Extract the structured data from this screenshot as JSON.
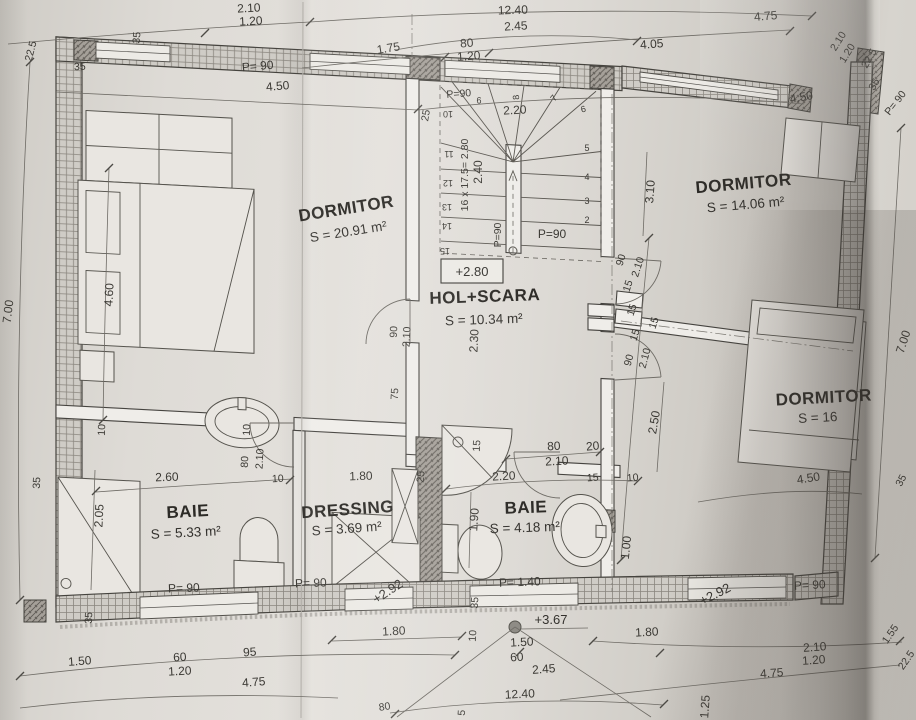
{
  "plan": {
    "rooms": [
      {
        "id": "dormitor-1",
        "name": "DORMITOR",
        "area": "S = 20.91 m²"
      },
      {
        "id": "dormitor-2",
        "name": "DORMITOR",
        "area": "S = 14.06 m²"
      },
      {
        "id": "dormitor-3",
        "name": "DORMITOR",
        "area": "S = 16"
      },
      {
        "id": "hol-scara",
        "name": "HOL+SCARA",
        "area": "S = 10.34 m²"
      },
      {
        "id": "baie-1",
        "name": "BAIE",
        "area": "S = 5.33 m²"
      },
      {
        "id": "dressing",
        "name": "DRESSING",
        "area": "S = 3.69 m²"
      },
      {
        "id": "baie-2",
        "name": "BAIE",
        "area": "S = 4.18 m²"
      }
    ],
    "level_marks": [
      "+2.80",
      "+2.92",
      "+3.67",
      "+2.92"
    ],
    "stair_note": "16 x 17.5= 2.80",
    "dimension_labels": [
      {
        "t": "2.10",
        "x": 249,
        "y": 12,
        "r": -3
      },
      {
        "t": "1.20",
        "x": 251,
        "y": 25,
        "r": -3
      },
      {
        "t": "12.40",
        "x": 513,
        "y": 14,
        "r": -2
      },
      {
        "t": "2.45",
        "x": 516,
        "y": 30,
        "r": -3
      },
      {
        "t": "1.75",
        "x": 389,
        "y": 52,
        "r": -9
      },
      {
        "t": "80",
        "x": 467,
        "y": 47,
        "r": -4
      },
      {
        "t": "1.20",
        "x": 469,
        "y": 60,
        "r": -4
      },
      {
        "t": "4.05",
        "x": 652,
        "y": 48,
        "r": -4
      },
      {
        "t": "4.75",
        "x": 766,
        "y": 20,
        "r": -5
      },
      {
        "t": "22.5",
        "x": 34,
        "y": 52,
        "r": -75,
        "c": "sm"
      },
      {
        "t": "35",
        "x": 80,
        "y": 70,
        "r": -3,
        "c": "sm"
      },
      {
        "t": "35",
        "x": 140,
        "y": 38,
        "r": -85,
        "c": "sm"
      },
      {
        "t": "P= 90",
        "x": 258,
        "y": 70,
        "r": -5
      },
      {
        "t": "4.50",
        "x": 278,
        "y": 90,
        "r": -5
      },
      {
        "t": "P=90",
        "x": 459,
        "y": 97,
        "r": -4,
        "c": "sm"
      },
      {
        "t": "2.20",
        "x": 515,
        "y": 114,
        "r": -3
      },
      {
        "t": "4.50",
        "x": 802,
        "y": 101,
        "r": -10
      },
      {
        "t": "2.10",
        "x": 841,
        "y": 43,
        "r": -58,
        "c": "sm"
      },
      {
        "t": "1.20",
        "x": 850,
        "y": 55,
        "r": -58,
        "c": "sm"
      },
      {
        "t": "22.5",
        "x": 872,
        "y": 60,
        "r": -60,
        "c": "sm"
      },
      {
        "t": "35",
        "x": 877,
        "y": 86,
        "r": -60,
        "c": "sm"
      },
      {
        "t": "P= 90",
        "x": 898,
        "y": 105,
        "r": -52,
        "c": "sm"
      },
      {
        "t": "9",
        "x": 479,
        "y": 97,
        "r": 180,
        "c": "xs"
      },
      {
        "t": "10",
        "x": 448,
        "y": 111,
        "r": 180,
        "c": "xs"
      },
      {
        "t": "8",
        "x": 519,
        "y": 97,
        "r": -95,
        "c": "xs"
      },
      {
        "t": "7",
        "x": 556,
        "y": 100,
        "r": -50,
        "c": "xs"
      },
      {
        "t": "6",
        "x": 584,
        "y": 112,
        "r": -15,
        "c": "xs"
      },
      {
        "t": "5",
        "x": 587,
        "y": 151,
        "c": "xs"
      },
      {
        "t": "4",
        "x": 587,
        "y": 180,
        "c": "xs"
      },
      {
        "t": "3",
        "x": 587,
        "y": 204,
        "c": "xs"
      },
      {
        "t": "2",
        "x": 587,
        "y": 223,
        "c": "xs"
      },
      {
        "t": "11",
        "x": 449,
        "y": 151,
        "r": 180,
        "c": "xs"
      },
      {
        "t": "12",
        "x": 448,
        "y": 180,
        "r": 180,
        "c": "xs"
      },
      {
        "t": "13",
        "x": 447,
        "y": 204,
        "r": 180,
        "c": "xs"
      },
      {
        "t": "14",
        "x": 447,
        "y": 223,
        "r": 180,
        "c": "xs"
      },
      {
        "t": "15",
        "x": 445,
        "y": 248,
        "r": 180,
        "c": "xs"
      },
      {
        "t": "16 x 17.5= 2.80",
        "x": 468,
        "y": 175,
        "r": -90,
        "c": "sm"
      },
      {
        "t": "2.40",
        "x": 482,
        "y": 172,
        "r": -90
      },
      {
        "t": "P=90",
        "x": 501,
        "y": 235,
        "r": -90,
        "c": "sm"
      },
      {
        "t": "P=90",
        "x": 552,
        "y": 238
      },
      {
        "t": "25",
        "x": 429,
        "y": 116,
        "r": -80,
        "c": "sm"
      },
      {
        "t": "25",
        "x": 424,
        "y": 477,
        "r": -85,
        "c": "sm"
      },
      {
        "t": "7.00",
        "x": 12,
        "y": 312,
        "r": -83
      },
      {
        "t": "4.60",
        "x": 113,
        "y": 295,
        "r": -87
      },
      {
        "t": "10",
        "x": 105,
        "y": 430,
        "r": -87,
        "c": "sm"
      },
      {
        "t": "35",
        "x": 40,
        "y": 483,
        "r": -87,
        "c": "sm"
      },
      {
        "t": "2.05",
        "x": 103,
        "y": 516,
        "r": -87
      },
      {
        "t": "2.60",
        "x": 167,
        "y": 481,
        "r": -2
      },
      {
        "t": "10",
        "x": 250,
        "y": 430,
        "r": -87,
        "c": "sm"
      },
      {
        "t": "80",
        "x": 248,
        "y": 462,
        "r": -87,
        "c": "sm"
      },
      {
        "t": "2.10",
        "x": 263,
        "y": 459,
        "r": -87,
        "c": "sm"
      },
      {
        "t": "10",
        "x": 278,
        "y": 482,
        "r": -3,
        "c": "sm"
      },
      {
        "t": "1.80",
        "x": 361,
        "y": 480,
        "r": -2
      },
      {
        "t": "90",
        "x": 397,
        "y": 332,
        "r": -87,
        "c": "sm"
      },
      {
        "t": "2.10",
        "x": 410,
        "y": 337,
        "r": -87,
        "c": "sm"
      },
      {
        "t": "75",
        "x": 398,
        "y": 394,
        "r": -87,
        "c": "sm"
      },
      {
        "t": "2.30",
        "x": 478,
        "y": 341,
        "r": -87
      },
      {
        "t": "35",
        "x": 92,
        "y": 618,
        "r": -87,
        "c": "sm"
      },
      {
        "t": "90",
        "x": 624,
        "y": 261,
        "r": -72,
        "c": "sm"
      },
      {
        "t": "2.10",
        "x": 641,
        "y": 268,
        "r": -72,
        "c": "sm"
      },
      {
        "t": "15",
        "x": 631,
        "y": 287,
        "r": -72,
        "c": "sm"
      },
      {
        "t": "15",
        "x": 635,
        "y": 311,
        "r": -72,
        "c": "sm"
      },
      {
        "t": "15",
        "x": 657,
        "y": 324,
        "r": -72,
        "c": "sm"
      },
      {
        "t": "15",
        "x": 638,
        "y": 336,
        "r": -72,
        "c": "sm"
      },
      {
        "t": "90",
        "x": 632,
        "y": 361,
        "r": -75,
        "c": "sm"
      },
      {
        "t": "2.10",
        "x": 648,
        "y": 359,
        "r": -75,
        "c": "sm"
      },
      {
        "t": "2.50",
        "x": 658,
        "y": 423,
        "r": -80
      },
      {
        "t": "1.00",
        "x": 630,
        "y": 548,
        "r": -84
      },
      {
        "t": "3.10",
        "x": 654,
        "y": 192,
        "r": -86
      },
      {
        "t": "15",
        "x": 480,
        "y": 446,
        "r": -86,
        "c": "sm"
      },
      {
        "t": "80",
        "x": 554,
        "y": 450,
        "r": -3
      },
      {
        "t": "2.10",
        "x": 557,
        "y": 465,
        "r": -3
      },
      {
        "t": "20",
        "x": 593,
        "y": 450,
        "r": -5
      },
      {
        "t": "2.20",
        "x": 504,
        "y": 480,
        "r": -3
      },
      {
        "t": "15",
        "x": 593,
        "y": 481,
        "r": -4,
        "c": "sm"
      },
      {
        "t": "10",
        "x": 633,
        "y": 481,
        "r": -5,
        "c": "sm"
      },
      {
        "t": "1.90",
        "x": 478,
        "y": 520,
        "r": -86
      },
      {
        "t": "P= 1.40",
        "x": 520,
        "y": 586,
        "r": -2
      },
      {
        "t": "4.50",
        "x": 809,
        "y": 482,
        "r": -9
      },
      {
        "t": "35",
        "x": 904,
        "y": 482,
        "r": -62,
        "c": "sm"
      },
      {
        "t": "7.00",
        "x": 907,
        "y": 343,
        "r": -72
      },
      {
        "t": "1.50",
        "x": 80,
        "y": 665,
        "r": -4
      },
      {
        "t": "60",
        "x": 180,
        "y": 661,
        "r": -3
      },
      {
        "t": "1.20",
        "x": 180,
        "y": 675,
        "r": -3
      },
      {
        "t": "95",
        "x": 250,
        "y": 656,
        "r": -4
      },
      {
        "t": "4.75",
        "x": 254,
        "y": 686,
        "r": -4
      },
      {
        "t": "1.80",
        "x": 394,
        "y": 635,
        "r": -3
      },
      {
        "t": "35",
        "x": 478,
        "y": 603,
        "r": -86,
        "c": "sm"
      },
      {
        "t": "10",
        "x": 476,
        "y": 636,
        "r": -86,
        "c": "sm"
      },
      {
        "t": "1.50",
        "x": 522,
        "y": 646,
        "r": -3
      },
      {
        "t": "60",
        "x": 517,
        "y": 661,
        "r": -3
      },
      {
        "t": "2.45",
        "x": 544,
        "y": 673,
        "r": -4
      },
      {
        "t": "12.40",
        "x": 520,
        "y": 698,
        "r": -3
      },
      {
        "t": "1.80",
        "x": 647,
        "y": 636,
        "r": -3
      },
      {
        "t": "P= 90",
        "x": 810,
        "y": 589,
        "r": -3
      },
      {
        "t": "2.10",
        "x": 815,
        "y": 651,
        "r": -4
      },
      {
        "t": "1.20",
        "x": 814,
        "y": 664,
        "r": -4
      },
      {
        "t": "4.75",
        "x": 772,
        "y": 677,
        "r": -4
      },
      {
        "t": "1.55",
        "x": 893,
        "y": 636,
        "r": -55,
        "c": "sm"
      },
      {
        "t": "22.5",
        "x": 909,
        "y": 662,
        "r": -55,
        "c": "sm"
      },
      {
        "t": "1.25",
        "x": 709,
        "y": 707,
        "r": -86
      },
      {
        "t": "80",
        "x": 385,
        "y": 710,
        "r": -8,
        "c": "sm"
      },
      {
        "t": "5",
        "x": 465,
        "y": 713,
        "r": -86,
        "c": "sm"
      },
      {
        "t": "P= 90",
        "x": 184,
        "y": 592,
        "r": -2
      },
      {
        "t": "P= 90",
        "x": 311,
        "y": 587,
        "r": -2
      }
    ]
  }
}
